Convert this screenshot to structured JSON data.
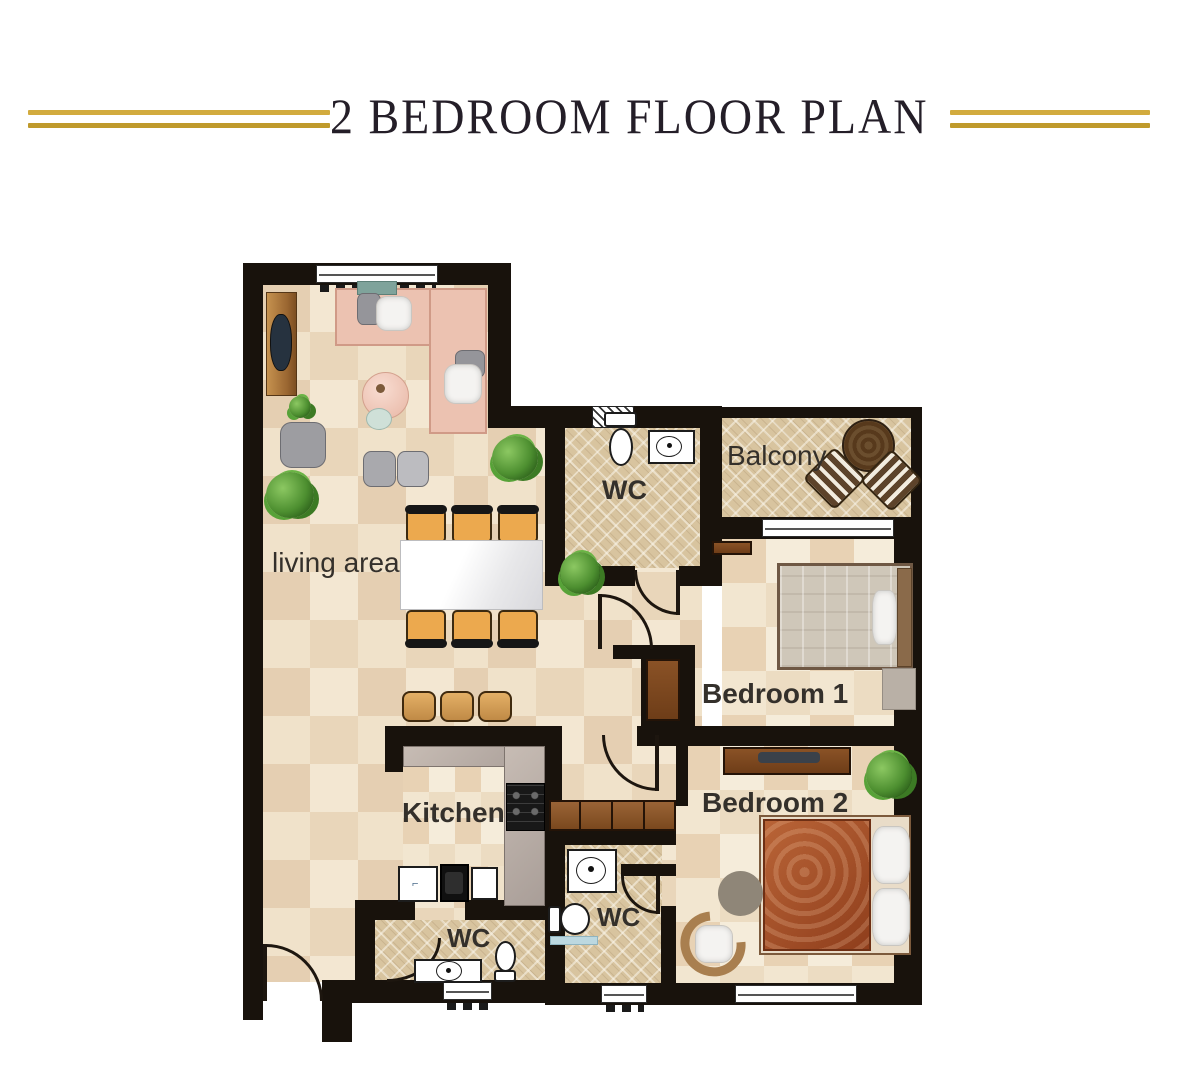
{
  "header": {
    "title": "2 BEDROOM FLOOR PLAN"
  },
  "rooms": {
    "living_area": {
      "label": "living area"
    },
    "wc_top": {
      "label": "WC"
    },
    "balcony": {
      "label": "Balcony"
    },
    "bedroom_1": {
      "label": "Bedroom 1"
    },
    "bedroom_2": {
      "label": "Bedroom 2"
    },
    "kitchen": {
      "label": "Kitchen"
    },
    "wc_inner": {
      "label": "WC"
    },
    "wc_guest": {
      "label": "WC"
    }
  },
  "colors": {
    "accent_gold": "#c9a435",
    "wall": "#18120c",
    "floor_tile": "#eedcc2",
    "wet_floor": "#d8c49f",
    "sofa_pink": "#ecc2b1",
    "bed2_duvet": "#a8512b",
    "wood_brown": "#8a5226",
    "counter_gray": "#b3a8a0"
  },
  "icons": {
    "toilet": "toilet-top-view",
    "sink": "sink-top-view",
    "stove": "stove-top-view",
    "plant": "potted-plant-top-view",
    "door": "door-swing-arc"
  }
}
